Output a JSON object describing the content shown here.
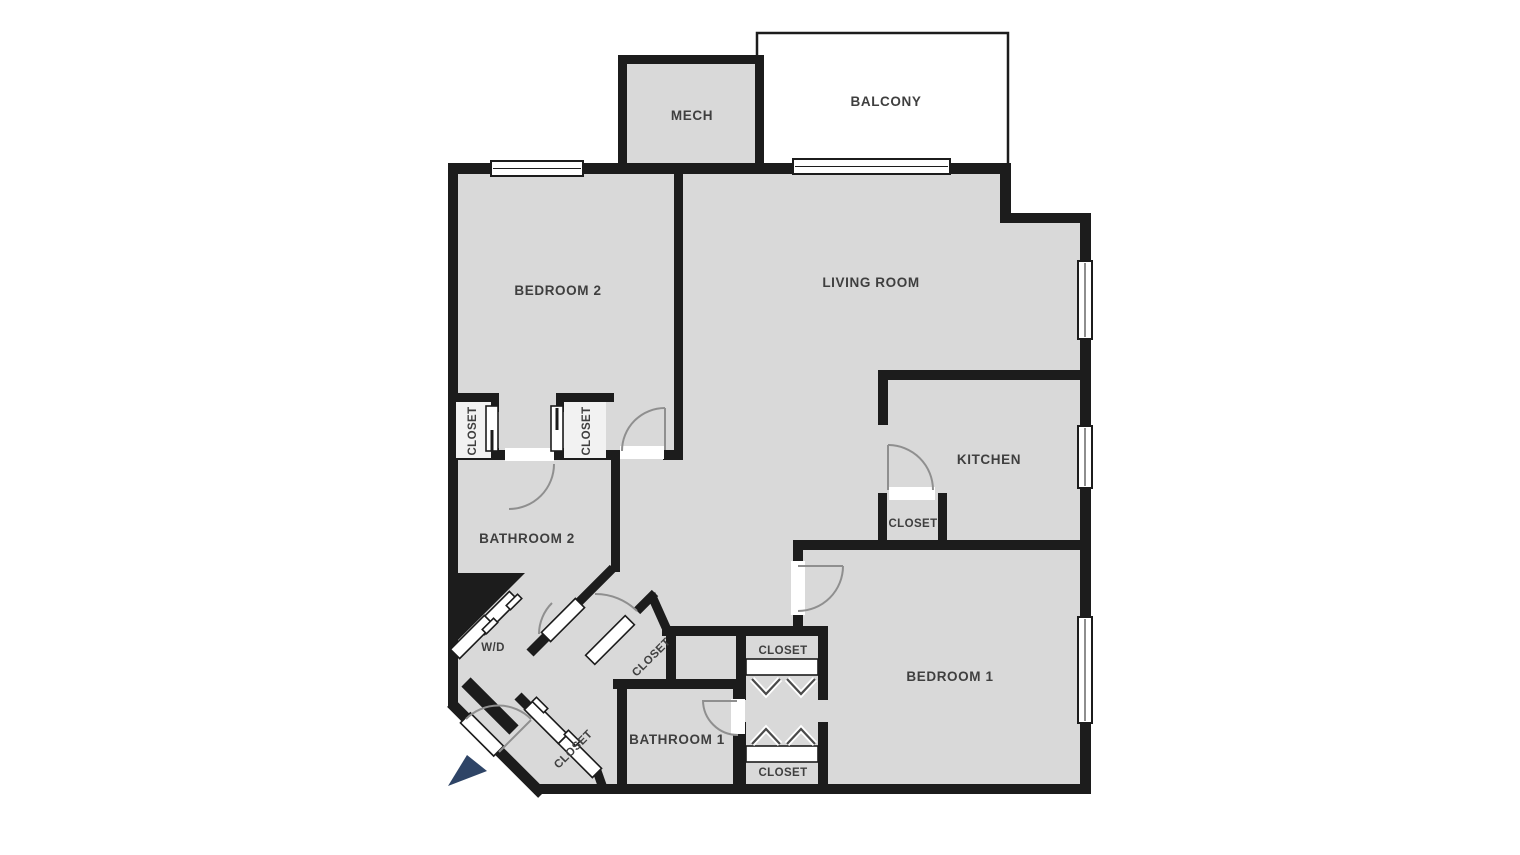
{
  "floorplan": {
    "title": "apartment-floor-plan",
    "rooms": {
      "balcony": {
        "label": "BALCONY"
      },
      "mech": {
        "label": "MECH"
      },
      "bedroom2": {
        "label": "BEDROOM 2"
      },
      "living_room": {
        "label": "LIVING ROOM"
      },
      "kitchen": {
        "label": "KITCHEN"
      },
      "bathroom2": {
        "label": "BATHROOM 2"
      },
      "wd": {
        "label": "W/D"
      },
      "bathroom1": {
        "label": "BATHROOM 1"
      },
      "bedroom1": {
        "label": "BEDROOM 1"
      },
      "closet": {
        "label": "CLOSET"
      }
    },
    "features": {
      "windows": 4,
      "balcony_slider": 1,
      "entry_marker": "navy-triangle"
    },
    "colors": {
      "floor": "#d9d9d9",
      "wall": "#1c1c1c",
      "outdoor": "#ffffff",
      "arc": "#8f8f8f",
      "label": "#3f3f3f",
      "entry_marker": "#2e4466"
    }
  }
}
